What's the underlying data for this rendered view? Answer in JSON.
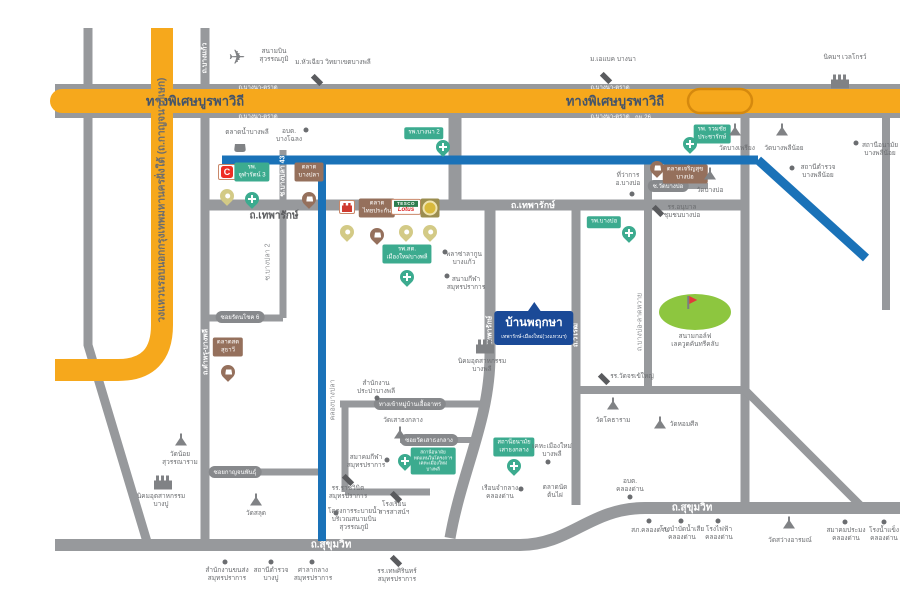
{
  "map_title": "แผนที่โครงการ บ้านพฤกษา เทพารักษ์-เมืองใหม่(วงแหวนฯ)",
  "colors": {
    "expressway_yellow": "#f6a81c",
    "road_gray": "#97999c",
    "canal_blue": "#1a72b8",
    "hospital_green": "#3cab8f",
    "market_brown": "#95705c",
    "project_navy": "#1b4a97",
    "golf_green": "#8dc63f",
    "bigc_red": "#ee2e24"
  },
  "project_callout": {
    "title": "บ้านพฤกษา",
    "subtitle": "เทพารักษ์-เมืองใหม่(วงแหวนฯ)"
  },
  "t": {
    "expressway": "ทางพิเศษบูรพาวิถี",
    "bangna_trat": "ถ.บางนา-ตราด",
    "km26": "กม.26",
    "ring_rd": "วงแหวนรอบนอกกรุงเทพมหานครฝั่งใต้ (ถ.กาญจนาภิเษก)",
    "thepharak_rd": "ถ.เทพารักษ์",
    "sukhumvit_rd": "ถ.สุขุมวิท",
    "bang_kaeo_rd": "ถ.บางแก้ว",
    "tamru_rd": "ถ.ตำหรุ-บางพลี",
    "wirot_rd": "ถ.วิโรฒ",
    "bangbo_latwai_rd": "ถ.บางบ่อ-ลาดหวาย",
    "khlong_bangpla": "คลองบางปลา",
    "soi_bangpla2": "ซ.บางปลา 2",
    "soi_bangpla43": "ซ.บางปลา 43",
    "soi_rattanachok": "ซอยรัตนโชค 6",
    "soi_kanchanaphan": "ซอยกาญจนพันธุ์",
    "soi_wat_bangbo": "ซ.วัดบางบ่อ",
    "access_uea": "ทางเข้าหมู่บ้านเอื้ออาทร",
    "soi_wat_saothongklang": "ซอยวัดเสาธงกลาง",
    "airport_l1": "สนามบิน",
    "airport_l2": "สุวรรณภูมิ",
    "huachiew": "ม.หัวเฉียว วิทยาเขตบางพลี",
    "abac": "ม.เอแบค บางนา",
    "wellgrow": "นิคมฯ เวลโกรว์",
    "talad_nam_bangphli": "ตลาดน้ำบางพลี",
    "obt_bangchalong_l1": "อบต.",
    "obt_bangchalong_l2": "บางโฉลง",
    "bigc": "C",
    "chularat_l1": "รพ.",
    "chularat_l2": "จุฬารัตน์ 3",
    "talad_bangpla_l1": "ตลาด",
    "talad_bangpla_l2": "บางปลา",
    "bangna2": "รพ.บางนา 2",
    "ruamchai_l1": "รพ. รวมชัย",
    "ruamchai_l2": "ประชารักษ์",
    "wat_bangphriang": "วัดบางเพรียง",
    "wat_bangphlinoi": "วัดบางพลีน้อย",
    "police_bangphlinoi_l1": "สถานีตำรวจ",
    "police_bangphlinoi_l2": "บางพลีน้อย",
    "anamai_bangphlinoi_l1": "สถานีอนามัย",
    "anamai_bangphlinoi_l2": "บางพลีน้อย",
    "amphoe_bangbo_l1": "ที่ว่าการ",
    "amphoe_bangbo_l2": "อ.บางบ่อ",
    "talad_charoensuk_l1": "ตลาดเจริญสุข",
    "talad_charoensuk_l2": "บางบ่อ",
    "wat_bangbo": "วัดบางบ่อ",
    "anuban_bangbo_l1": "รร.อนุบาล",
    "anuban_bangbo_l2": "ชุมชนบางบ่อ",
    "rp_bangbo": "รพ.บางบ่อ",
    "talad_thaiprakan_l1": "ตลาด",
    "talad_thaiprakan_l2": "ไทยประกัน",
    "tesco_l1": "TESCO",
    "tesco_l2": "Lotus",
    "rpst_l1": "รพ.สต.",
    "rpst_l2": "เมืองใหม่บางพลี",
    "plaza_lagoon_l1": "พลาซ่าลากูน",
    "plaza_lagoon_l2": "บางแก้ว",
    "stadium_l1": "สนามกีฬา",
    "stadium_l2": "สมุทรปราการ",
    "talad_suthawi_l1": "ตลาดสด",
    "talad_suthawi_l2": "สุธาวี",
    "nikhom_bangphli_l1": "นิคมอุตสาหกรรม",
    "nikhom_bangphli_l2": "บางพลี",
    "golf_l1": "สนามกอล์ฟ",
    "golf_l2": "เลควูดคันทรีคลับ",
    "school_chorakhe": "รร.วัดจรเข้ใหญ่",
    "wat_khotharam": "วัดโคธาราม",
    "wat_homsin": "วัดหอมศีล",
    "obt_khlongdan_l1": "อบต.",
    "obt_khlongdan_l2": "คลองด่าน",
    "prapa_l1": "สำนักงาน",
    "prapa_l2": "ประปาบางพลี",
    "wat_saothongklang": "วัดเสาธงกลาง",
    "anamai_l1": "สถานีอนามัย",
    "anamai_l2": "ทดแทนในโครงการ",
    "anamai_l3": "เคหะเมืองใหม่",
    "anamai_l4": "บางพลี",
    "sports_assoc_l1": "สมาคมกีฬา",
    "sports_assoc_l2": "สมุทรปราการ",
    "rachwinit_l1": "รร.ราชวินิต",
    "rachwinit_l2": "สมุทรปราการ",
    "drainage_l1": "โครงการระบายน้ำ",
    "drainage_l2": "บริเวณสนามบิน",
    "drainage_l3": "สุวรรณภูมิ",
    "sarasas_l1": "โรงเรียน",
    "sarasas_l2": "สารสาสน์ฯ",
    "anamai_stk_l1": "สถานีอนามัย",
    "anamai_stk_l2": "เสาธงกลาง",
    "kheha_l1": "เคหะเมืองใหม่",
    "kheha_l2": "บางพลี",
    "prison_l1": "เรือนจำกลาง",
    "prison_l2": "คลองด่าน",
    "taladnat_l1": "ตลาดนัด",
    "taladnat_l2": "ต้นไผ่",
    "wat_noi_l1": "วัดน้อย",
    "wat_noi_l2": "สุวรรณาราม",
    "nikhom_bangpu_l1": "นิคมอุตสาหกรรม",
    "nikhom_bangpu_l2": "บางปู",
    "wat_salut": "วัดสลุด",
    "transport_l1": "สำนักงานขนส่ง",
    "transport_l2": "สมุทรปราการ",
    "police_bangpu_l1": "สถานีตำรวจ",
    "police_bangpu_l2": "บางปู",
    "city_hall_l1": "ศาลากลาง",
    "city_hall_l2": "สมุทรปราการ",
    "thepsirin_l1": "รร.เทพศิรินทร์",
    "thepsirin_l2": "สมุทรปราการ",
    "sp_khlongdan": "สภ.คลองด่าน",
    "wastewater_l1": "โรงบำบัดน้ำเสีย",
    "wastewater_l2": "คลองด่าน",
    "power_l1": "โรงไฟฟ้า",
    "power_l2": "คลองด่าน",
    "wat_sawang": "วัดสว่างอารมณ์",
    "fishery_l1": "สมาคมประมง",
    "fishery_l2": "คลองด่าน",
    "ice_l1": "โรงน้ำแข็ง",
    "ice_l2": "คลองด่าน"
  }
}
